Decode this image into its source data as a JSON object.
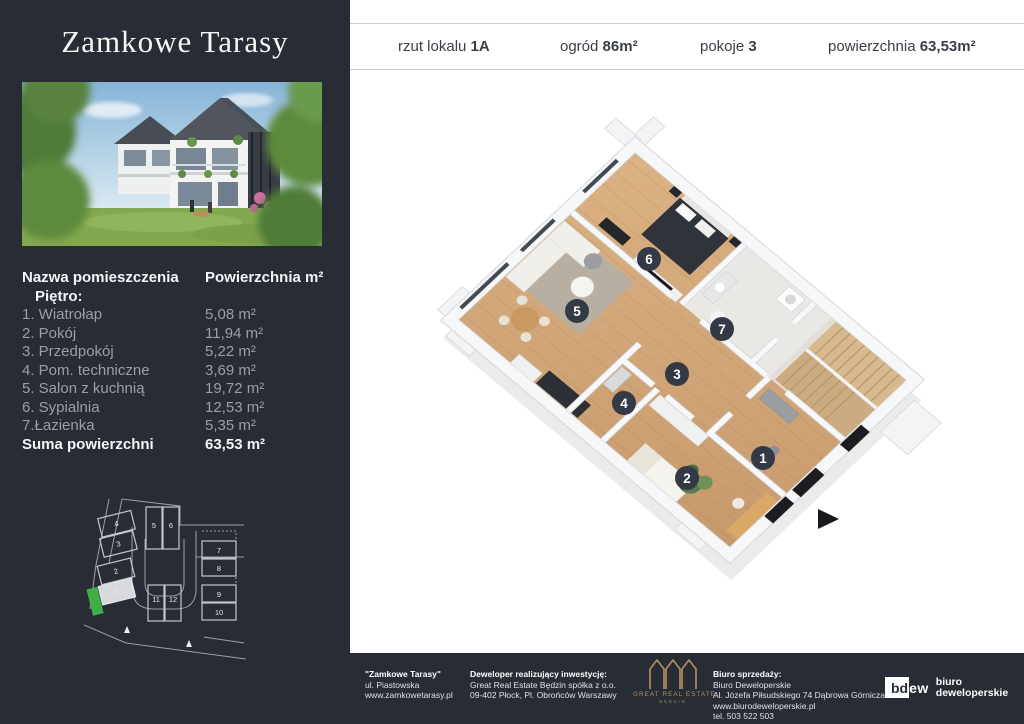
{
  "sidebar": {
    "logo": "Zamkowe Tarasy",
    "table": {
      "header_name": "Nazwa pomieszczenia",
      "header_area": "Powierzchnia m²",
      "floor_label": "Piętro:",
      "rows": [
        {
          "name": "1. Wiatrołap",
          "area": "5,08 m²"
        },
        {
          "name": "2. Pokój",
          "area": "11,94 m²"
        },
        {
          "name": "3. Przedpokój",
          "area": "5,22 m²"
        },
        {
          "name": "4. Pom. techniczne",
          "area": "3,69 m²"
        },
        {
          "name": "5. Salon z kuchnią",
          "area": "19,72 m²"
        },
        {
          "name": "6. Sypialnia",
          "area": "12,53 m²"
        },
        {
          "name": "7.Łazienka",
          "area": "5,35 m²"
        }
      ],
      "total_label": "Suma powierzchni",
      "total_value": "63,53 m²"
    },
    "siteplan_units": [
      "1",
      "2",
      "3",
      "4",
      "5",
      "6",
      "7",
      "8",
      "9",
      "10",
      "11",
      "12"
    ]
  },
  "header": {
    "items": [
      {
        "label": "rzut lokalu",
        "value": "1A"
      },
      {
        "label": "ogród",
        "value": "86m²"
      },
      {
        "label": "pokoje",
        "value": "3"
      },
      {
        "label": "powierzchnia",
        "value": "63,53m²"
      }
    ]
  },
  "floorplan": {
    "badges": [
      "1",
      "2",
      "3",
      "4",
      "5",
      "6",
      "7"
    ]
  },
  "footer": {
    "col1": {
      "title": "\"Zamkowe Tarasy\"",
      "lines": [
        "ul. Piastowska",
        "www.zamkowetarasy.pl"
      ]
    },
    "col2": {
      "title": "Deweloper realizujący inwestycję:",
      "lines": [
        "Great Real Estate Będzin spółka z o.o.",
        "09-402 Płock, Pl. Obrońców Warszawy"
      ]
    },
    "gre_logo": {
      "line1": "GREAT REAL ESTATE",
      "line2": "BĘDZIN"
    },
    "col3": {
      "title": "Biuro sprzedaży:",
      "lines": [
        "Biuro Deweloperskie",
        "Al. Józefa Piłsudskiego 74 Dąbrowa Górnicza",
        "www.biurodeweloperskie.pl",
        "tel. 503 522 503"
      ]
    },
    "bdew_logo": {
      "mark_dark": "bd",
      "mark_light": "ew",
      "text1": "biuro",
      "text2": "deweloperskie"
    }
  },
  "colors": {
    "dark_bg": "#272c35",
    "accent_green": "#3fae49",
    "gold": "#b49265",
    "wood": "#d0a678",
    "badge": "#333945"
  }
}
